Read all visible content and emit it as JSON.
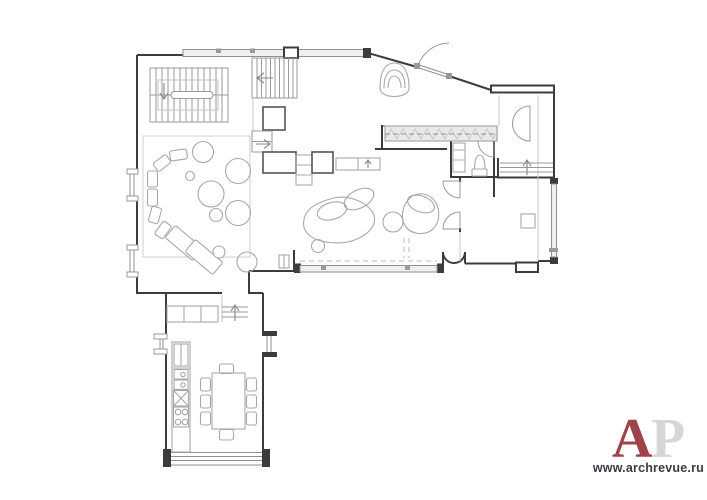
{
  "watermark": {
    "letter_a": "A",
    "letter_p": "P",
    "letter_a_color": "#9e4347",
    "letter_p_color": "#d6d6d6",
    "url_text": "www.archrevue.ru",
    "url_color": "#3b3b46"
  },
  "palette": {
    "background": "#ffffff",
    "wall_color": "#3c3c3c",
    "furniture_stroke": "#a8a8a8",
    "glazing_fill": "#efefef",
    "stair_stroke": "#9a9a9a",
    "rug_stroke": "#cfcfcf"
  }
}
